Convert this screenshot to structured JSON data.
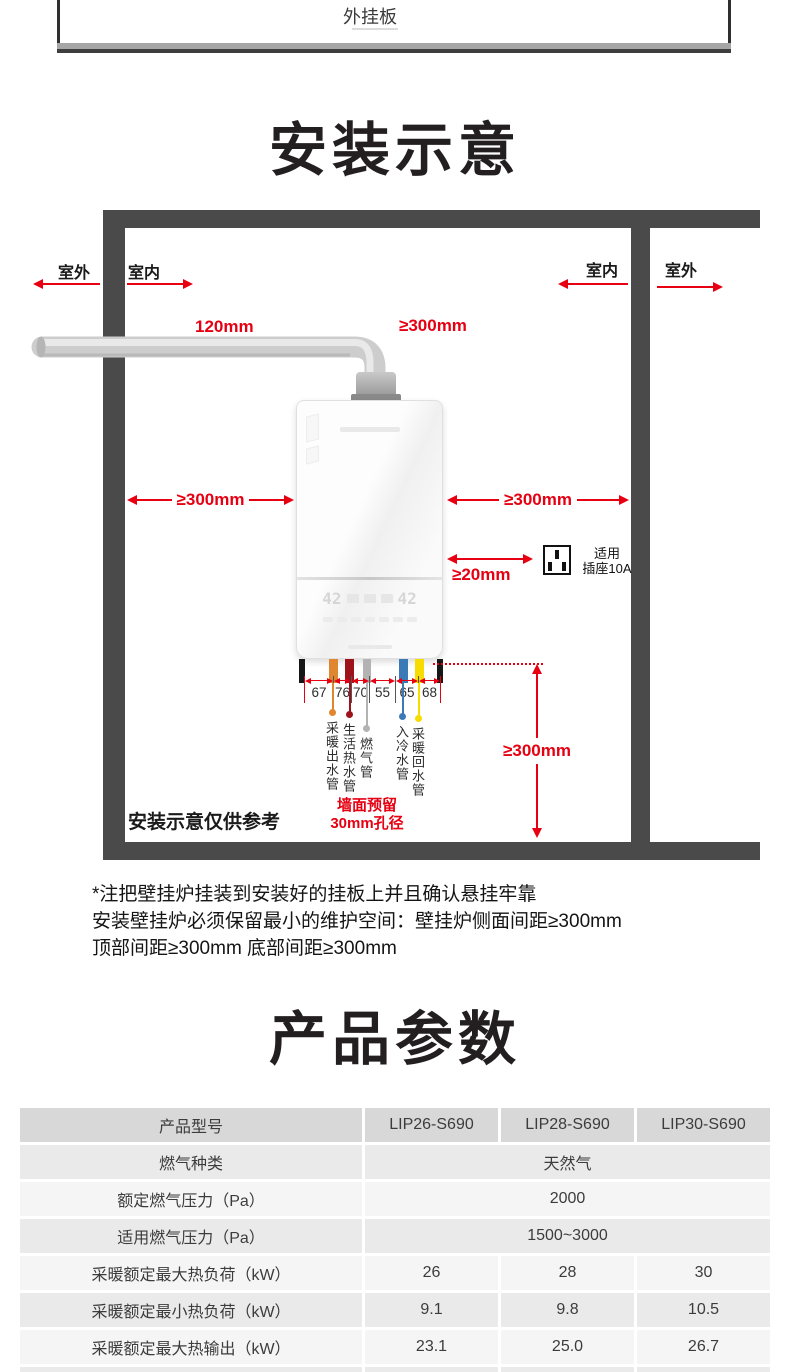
{
  "page": {
    "bg": "#ffffff",
    "accent_red": "#e60012",
    "wall_color": "#4a4a4a"
  },
  "top_plate": {
    "label": "外挂板"
  },
  "install": {
    "title": "安装示意",
    "outdoor_left": "室外",
    "indoor_left": "室内",
    "indoor_right": "室内",
    "outdoor_right": "室外",
    "dim_flue": "120mm",
    "dim_top": "≥300mm",
    "dim_left": "≥300mm",
    "dim_right": "≥300mm",
    "dim_socket": "≥20mm",
    "dim_bottom": "≥300mm",
    "socket_label_line1": "适用",
    "socket_label_line2": "插座10A",
    "pipe_spacings": [
      "67",
      "76",
      "70",
      "55",
      "65",
      "68"
    ],
    "pipes": [
      {
        "name": "采暖出水管",
        "color": "#e0862e"
      },
      {
        "name": "生活热水管",
        "color": "#9e1219"
      },
      {
        "name": "燃气管",
        "color": "#b3b3b3"
      },
      {
        "name": "入冷水管",
        "color": "#3c7ab7"
      },
      {
        "name": "采暖回水管",
        "color": "#f7dc00"
      }
    ],
    "wall_hole_note_line1": "墙面预留",
    "wall_hole_note_line2": "30mm孔径",
    "reference_note": "安装示意仅供参考",
    "boiler": {
      "display_left": "42",
      "display_right": "42"
    }
  },
  "install_notes": [
    "*注把壁挂炉挂装到安装好的挂板上并且确认悬挂牢靠",
    "安装壁挂炉必须保留最小的维护空间：壁挂炉侧面间距≥300mm",
    "顶部间距≥300mm 底部间距≥300mm"
  ],
  "params": {
    "title": "产品参数",
    "table": {
      "header": [
        "产品型号",
        "LIP26-S690",
        "LIP28-S690",
        "LIP30-S690"
      ],
      "rows": [
        {
          "label": "燃气种类",
          "span": "天然气"
        },
        {
          "label": "额定燃气压力（Pa）",
          "span": "2000"
        },
        {
          "label": "适用燃气压力（Pa）",
          "span": "1500~3000"
        },
        {
          "label": "采暖额定最大热负荷（kW）",
          "values": [
            "26",
            "28",
            "30"
          ]
        },
        {
          "label": "采暖额定最小热负荷（kW）",
          "values": [
            "9.1",
            "9.8",
            "10.5"
          ]
        },
        {
          "label": "采暖额定最大热输出（kW）",
          "values": [
            "23.1",
            "25.0",
            "26.7"
          ]
        }
      ]
    }
  }
}
